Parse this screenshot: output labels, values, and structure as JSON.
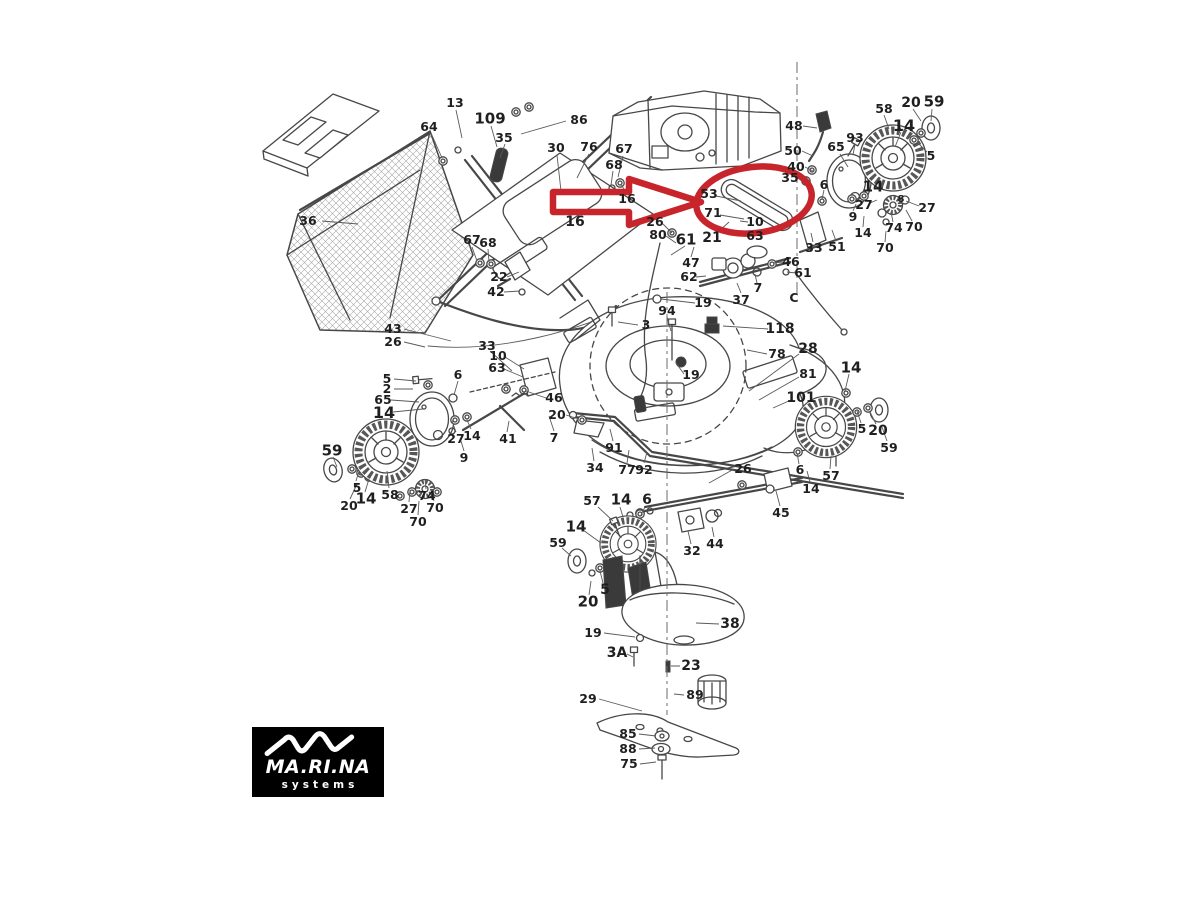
{
  "colors": {
    "page_bg": "#ffffff",
    "highlight": "#c8242b",
    "line": "#474747",
    "label_color": "#1f1f1f",
    "logo_bg": "#000000"
  },
  "logo": {
    "brand": "MA.RI.NA",
    "tagline": "systems"
  },
  "diagram": {
    "title": "Lawn mower exploded parts diagram",
    "highlighted_labels": [
      "53",
      "71",
      "21",
      "10",
      "63"
    ],
    "labels": [
      {
        "t": "13",
        "x": 455,
        "y": 103
      },
      {
        "t": "64",
        "x": 429,
        "y": 127
      },
      {
        "t": "109",
        "x": 490,
        "y": 119,
        "s": 15
      },
      {
        "t": "35",
        "x": 504,
        "y": 138
      },
      {
        "t": "30",
        "x": 556,
        "y": 148
      },
      {
        "t": "86",
        "x": 579,
        "y": 120
      },
      {
        "t": "76",
        "x": 589,
        "y": 147
      },
      {
        "t": "36",
        "x": 308,
        "y": 221
      },
      {
        "t": "67",
        "x": 624,
        "y": 149
      },
      {
        "t": "68",
        "x": 614,
        "y": 165
      },
      {
        "t": "16",
        "x": 627,
        "y": 199
      },
      {
        "t": "16",
        "x": 575,
        "y": 222,
        "s": 14
      },
      {
        "t": "67",
        "x": 472,
        "y": 240
      },
      {
        "t": "68",
        "x": 488,
        "y": 243
      },
      {
        "t": "22",
        "x": 499,
        "y": 277
      },
      {
        "t": "42",
        "x": 496,
        "y": 292
      },
      {
        "t": "43",
        "x": 393,
        "y": 329
      },
      {
        "t": "26",
        "x": 393,
        "y": 342
      },
      {
        "t": "26",
        "x": 655,
        "y": 222
      },
      {
        "t": "80",
        "x": 658,
        "y": 235
      },
      {
        "t": "61",
        "x": 686,
        "y": 240,
        "s": 15
      },
      {
        "t": "47",
        "x": 691,
        "y": 263
      },
      {
        "t": "62",
        "x": 689,
        "y": 277
      },
      {
        "t": "53",
        "x": 709,
        "y": 194
      },
      {
        "t": "71",
        "x": 713,
        "y": 213
      },
      {
        "t": "21",
        "x": 712,
        "y": 238,
        "s": 14
      },
      {
        "t": "10",
        "x": 755,
        "y": 222
      },
      {
        "t": "63",
        "x": 755,
        "y": 236
      },
      {
        "t": "37",
        "x": 741,
        "y": 300
      },
      {
        "t": "7",
        "x": 758,
        "y": 288
      },
      {
        "t": "C",
        "x": 794,
        "y": 298
      },
      {
        "t": "46",
        "x": 791,
        "y": 262
      },
      {
        "t": "61",
        "x": 803,
        "y": 273
      },
      {
        "t": "33",
        "x": 814,
        "y": 248
      },
      {
        "t": "51",
        "x": 837,
        "y": 247
      },
      {
        "t": "48",
        "x": 794,
        "y": 126
      },
      {
        "t": "50",
        "x": 793,
        "y": 151
      },
      {
        "t": "40",
        "x": 796,
        "y": 167
      },
      {
        "t": "35",
        "x": 790,
        "y": 178
      },
      {
        "t": "6",
        "x": 824,
        "y": 185
      },
      {
        "t": "65",
        "x": 836,
        "y": 147
      },
      {
        "t": "93",
        "x": 855,
        "y": 138
      },
      {
        "t": "58",
        "x": 884,
        "y": 109
      },
      {
        "t": "14",
        "x": 904,
        "y": 126,
        "s": 16
      },
      {
        "t": "20",
        "x": 911,
        "y": 103,
        "s": 14
      },
      {
        "t": "59",
        "x": 934,
        "y": 102,
        "s": 15
      },
      {
        "t": "5",
        "x": 931,
        "y": 156
      },
      {
        "t": "27",
        "x": 864,
        "y": 205
      },
      {
        "t": "9",
        "x": 853,
        "y": 217
      },
      {
        "t": "14",
        "x": 873,
        "y": 187,
        "s": 15
      },
      {
        "t": "14",
        "x": 863,
        "y": 233
      },
      {
        "t": "8",
        "x": 901,
        "y": 200,
        "s": 10
      },
      {
        "t": "27",
        "x": 927,
        "y": 208
      },
      {
        "t": "74",
        "x": 894,
        "y": 228
      },
      {
        "t": "70",
        "x": 914,
        "y": 227
      },
      {
        "t": "70",
        "x": 885,
        "y": 248
      },
      {
        "t": "3",
        "x": 646,
        "y": 325
      },
      {
        "t": "94",
        "x": 667,
        "y": 311
      },
      {
        "t": "19",
        "x": 703,
        "y": 303
      },
      {
        "t": "118",
        "x": 780,
        "y": 329,
        "s": 14
      },
      {
        "t": "78",
        "x": 777,
        "y": 354
      },
      {
        "t": "28",
        "x": 808,
        "y": 349,
        "s": 14
      },
      {
        "t": "81",
        "x": 808,
        "y": 374
      },
      {
        "t": "101",
        "x": 801,
        "y": 398,
        "s": 14
      },
      {
        "t": "19",
        "x": 691,
        "y": 375
      },
      {
        "t": "33",
        "x": 487,
        "y": 346
      },
      {
        "t": "10",
        "x": 498,
        "y": 356
      },
      {
        "t": "63",
        "x": 497,
        "y": 368
      },
      {
        "t": "5",
        "x": 387,
        "y": 379
      },
      {
        "t": "2",
        "x": 387,
        "y": 389
      },
      {
        "t": "65",
        "x": 383,
        "y": 400
      },
      {
        "t": "14",
        "x": 384,
        "y": 413,
        "s": 16
      },
      {
        "t": "6",
        "x": 458,
        "y": 375
      },
      {
        "t": "27",
        "x": 456,
        "y": 439
      },
      {
        "t": "14",
        "x": 472,
        "y": 436
      },
      {
        "t": "9",
        "x": 464,
        "y": 458
      },
      {
        "t": "41",
        "x": 508,
        "y": 439
      },
      {
        "t": "59",
        "x": 332,
        "y": 451,
        "s": 15
      },
      {
        "t": "5",
        "x": 357,
        "y": 488
      },
      {
        "t": "14",
        "x": 366,
        "y": 499,
        "s": 15
      },
      {
        "t": "20",
        "x": 349,
        "y": 506
      },
      {
        "t": "58",
        "x": 390,
        "y": 495
      },
      {
        "t": "74",
        "x": 427,
        "y": 496
      },
      {
        "t": "27",
        "x": 409,
        "y": 509
      },
      {
        "t": "70",
        "x": 435,
        "y": 508
      },
      {
        "t": "70",
        "x": 418,
        "y": 522
      },
      {
        "t": "46",
        "x": 554,
        "y": 398
      },
      {
        "t": "20",
        "x": 557,
        "y": 415
      },
      {
        "t": "7",
        "x": 554,
        "y": 438
      },
      {
        "t": "91",
        "x": 614,
        "y": 448
      },
      {
        "t": "34",
        "x": 595,
        "y": 468
      },
      {
        "t": "77",
        "x": 627,
        "y": 470
      },
      {
        "t": "92",
        "x": 644,
        "y": 470
      },
      {
        "t": "26",
        "x": 743,
        "y": 469
      },
      {
        "t": "6",
        "x": 800,
        "y": 470
      },
      {
        "t": "57",
        "x": 831,
        "y": 476
      },
      {
        "t": "14",
        "x": 811,
        "y": 489
      },
      {
        "t": "45",
        "x": 781,
        "y": 513
      },
      {
        "t": "32",
        "x": 692,
        "y": 551
      },
      {
        "t": "44",
        "x": 715,
        "y": 544
      },
      {
        "t": "14",
        "x": 851,
        "y": 368,
        "s": 15
      },
      {
        "t": "5",
        "x": 862,
        "y": 429
      },
      {
        "t": "20",
        "x": 878,
        "y": 431,
        "s": 14
      },
      {
        "t": "59",
        "x": 889,
        "y": 448
      },
      {
        "t": "57",
        "x": 592,
        "y": 501
      },
      {
        "t": "14",
        "x": 621,
        "y": 500,
        "s": 15
      },
      {
        "t": "6",
        "x": 647,
        "y": 500,
        "s": 14
      },
      {
        "t": "14",
        "x": 576,
        "y": 527,
        "s": 15
      },
      {
        "t": "59",
        "x": 558,
        "y": 543
      },
      {
        "t": "5",
        "x": 605,
        "y": 590,
        "s": 14
      },
      {
        "t": "20",
        "x": 588,
        "y": 602,
        "s": 15
      },
      {
        "t": "19",
        "x": 593,
        "y": 633
      },
      {
        "t": "38",
        "x": 730,
        "y": 624,
        "s": 14
      },
      {
        "t": "3A",
        "x": 617,
        "y": 653,
        "s": 14
      },
      {
        "t": "23",
        "x": 691,
        "y": 666,
        "s": 14
      },
      {
        "t": "89",
        "x": 695,
        "y": 695
      },
      {
        "t": "29",
        "x": 588,
        "y": 699
      },
      {
        "t": "85",
        "x": 628,
        "y": 734
      },
      {
        "t": "88",
        "x": 628,
        "y": 749
      },
      {
        "t": "75",
        "x": 629,
        "y": 764
      }
    ]
  }
}
